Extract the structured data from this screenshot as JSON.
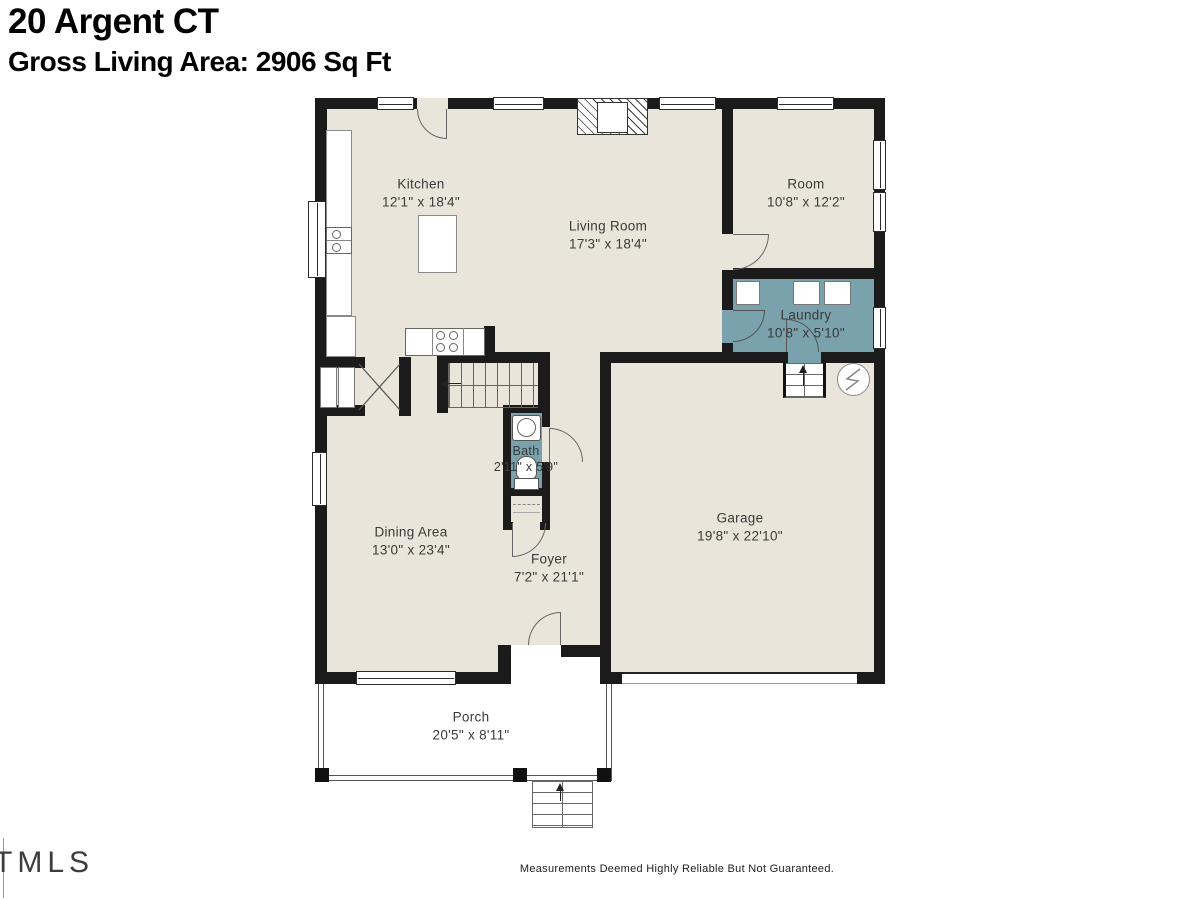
{
  "header": {
    "address": "20 Argent CT",
    "area_line": "Gross Living Area: 2906 Sq Ft"
  },
  "rooms": {
    "kitchen": {
      "name": "Kitchen",
      "dims": "12'1\" x 18'4\""
    },
    "living": {
      "name": "Living Room",
      "dims": "17'3\" x 18'4\""
    },
    "room": {
      "name": "Room",
      "dims": "10'8\" x 12'2\""
    },
    "laundry": {
      "name": "Laundry",
      "dims": "10'8\" x 5'10\""
    },
    "bath": {
      "name": "Bath",
      "dims": "2'11\" x 5'9\""
    },
    "dining": {
      "name": "Dining Area",
      "dims": "13'0\" x 23'4\""
    },
    "foyer": {
      "name": "Foyer",
      "dims": "7'2\" x 21'1\""
    },
    "garage": {
      "name": "Garage",
      "dims": "19'8\" x 22'10\""
    },
    "porch": {
      "name": "Porch",
      "dims": "20'5\" x 8'11\""
    }
  },
  "footer": {
    "logo": "TMLS",
    "disclaimer": "Measurements Deemed Highly Reliable But Not Guaranteed."
  },
  "colors": {
    "floor": "#eae5da",
    "wet": "#79a2ac",
    "wall": "#1b1b1b",
    "porch": "#ffffff"
  }
}
